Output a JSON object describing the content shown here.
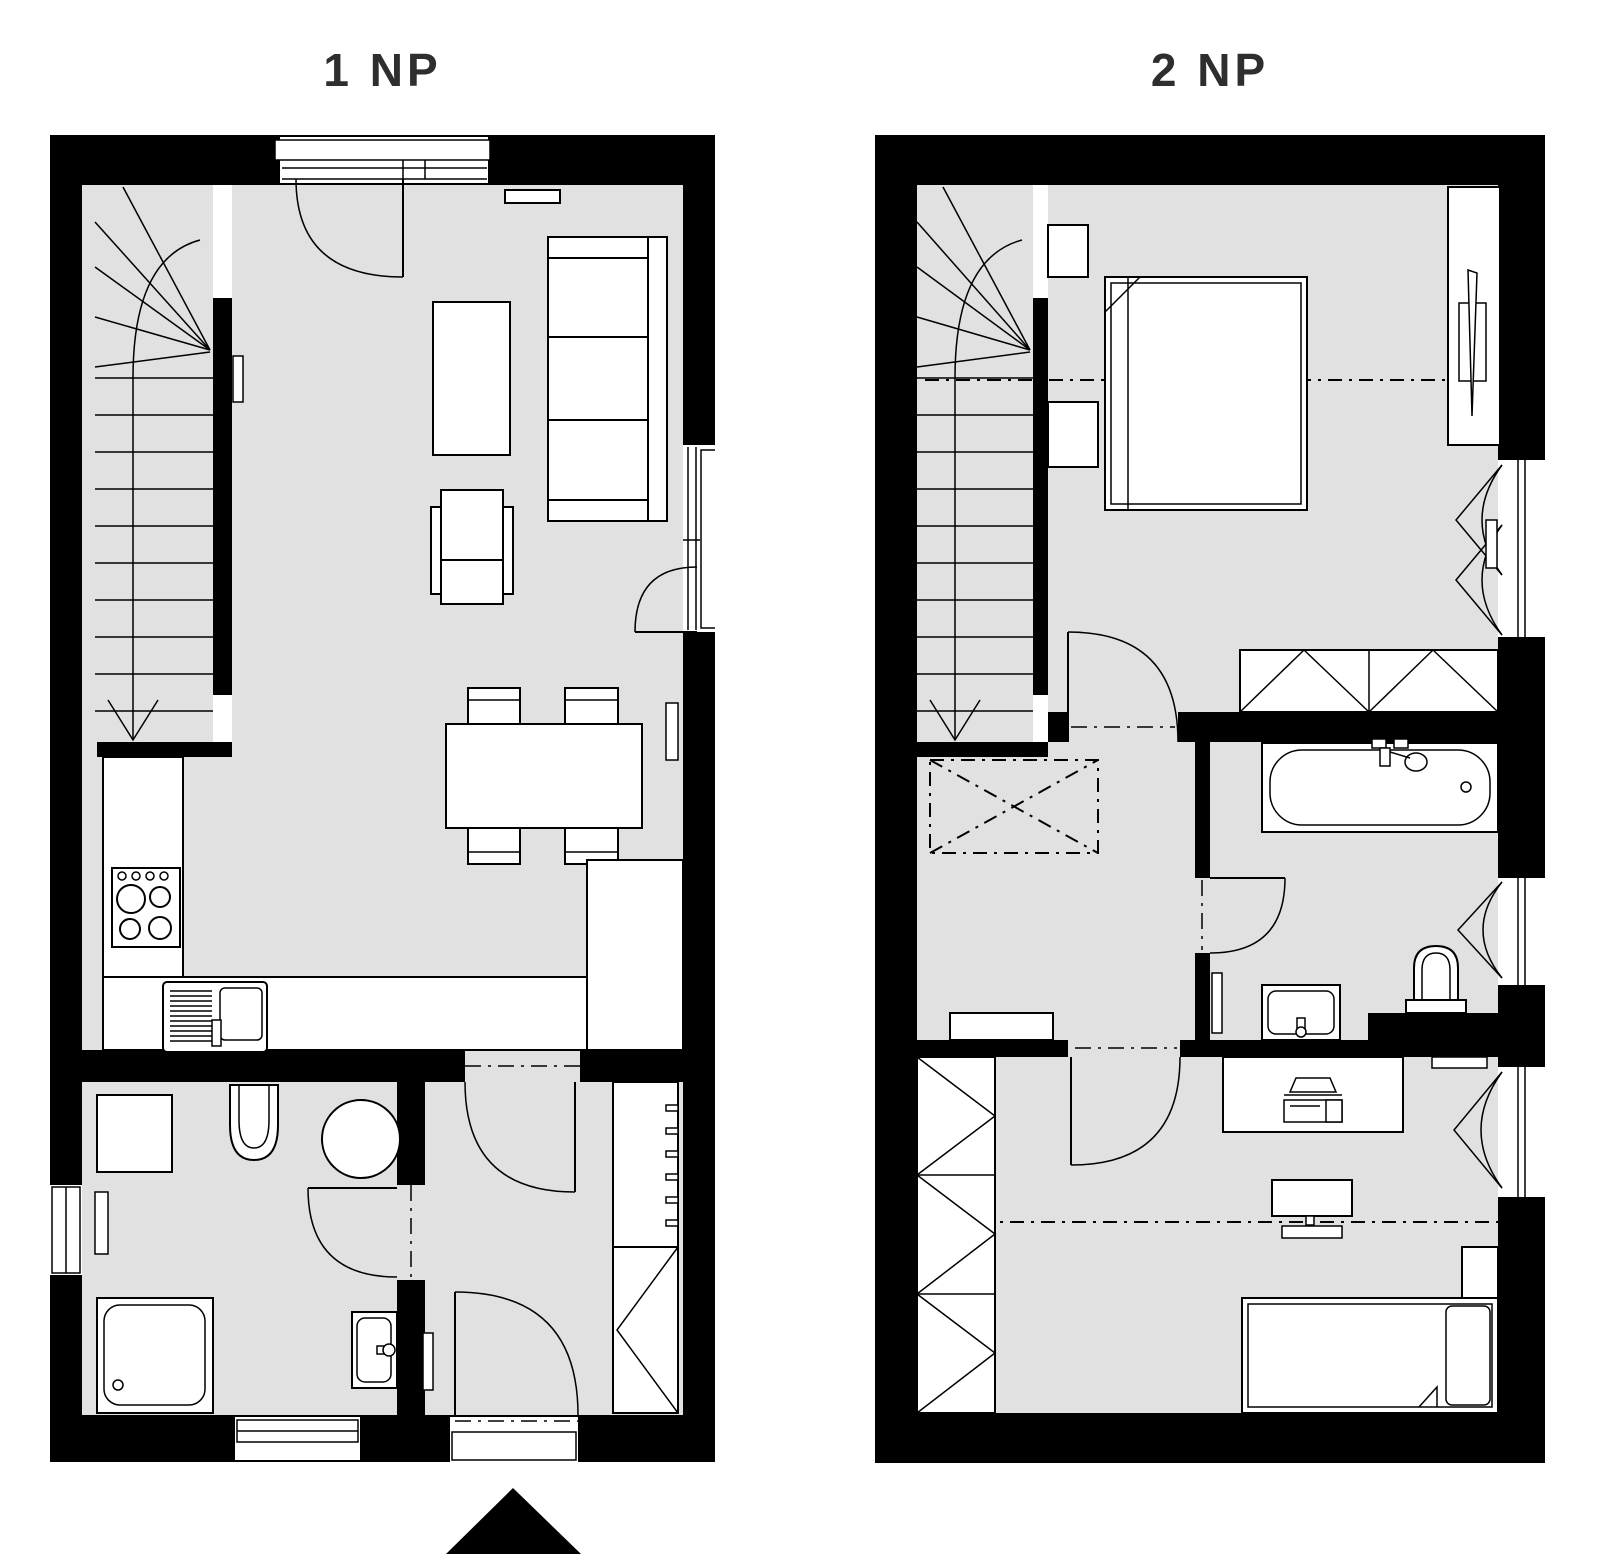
{
  "page": {
    "background": "#ffffff"
  },
  "colors": {
    "wall": "#000000",
    "floor": "#e1e1e1",
    "line": "#000000",
    "title": "#2e2e2e"
  },
  "plans": [
    {
      "title": "1 NP",
      "rooms": [
        "staircase",
        "living-room",
        "kitchen",
        "dining-area",
        "bathroom",
        "hallway"
      ],
      "furniture": [
        "entrance-door",
        "sofa",
        "coffee-table",
        "tv-shelf",
        "armchair",
        "dining-table",
        "dining-chairs",
        "kitchen-counter",
        "stove",
        "kitchen-sink",
        "tall-cabinet",
        "toilet",
        "washing-machine",
        "shower",
        "washbasin",
        "radiator",
        "coat-rack",
        "wardrobe",
        "terrace-door",
        "entrance-arrow"
      ]
    },
    {
      "title": "2 NP",
      "rooms": [
        "staircase",
        "landing",
        "bedroom",
        "bathroom",
        "kids-room"
      ],
      "furniture": [
        "double-bed",
        "nightstand",
        "wardrobe",
        "window-bay",
        "casement-window",
        "bathtub",
        "toilet",
        "washbasin",
        "radiator",
        "desk",
        "laptop",
        "monitor",
        "single-bed",
        "closet",
        "void-opening",
        "shelf"
      ]
    }
  ]
}
